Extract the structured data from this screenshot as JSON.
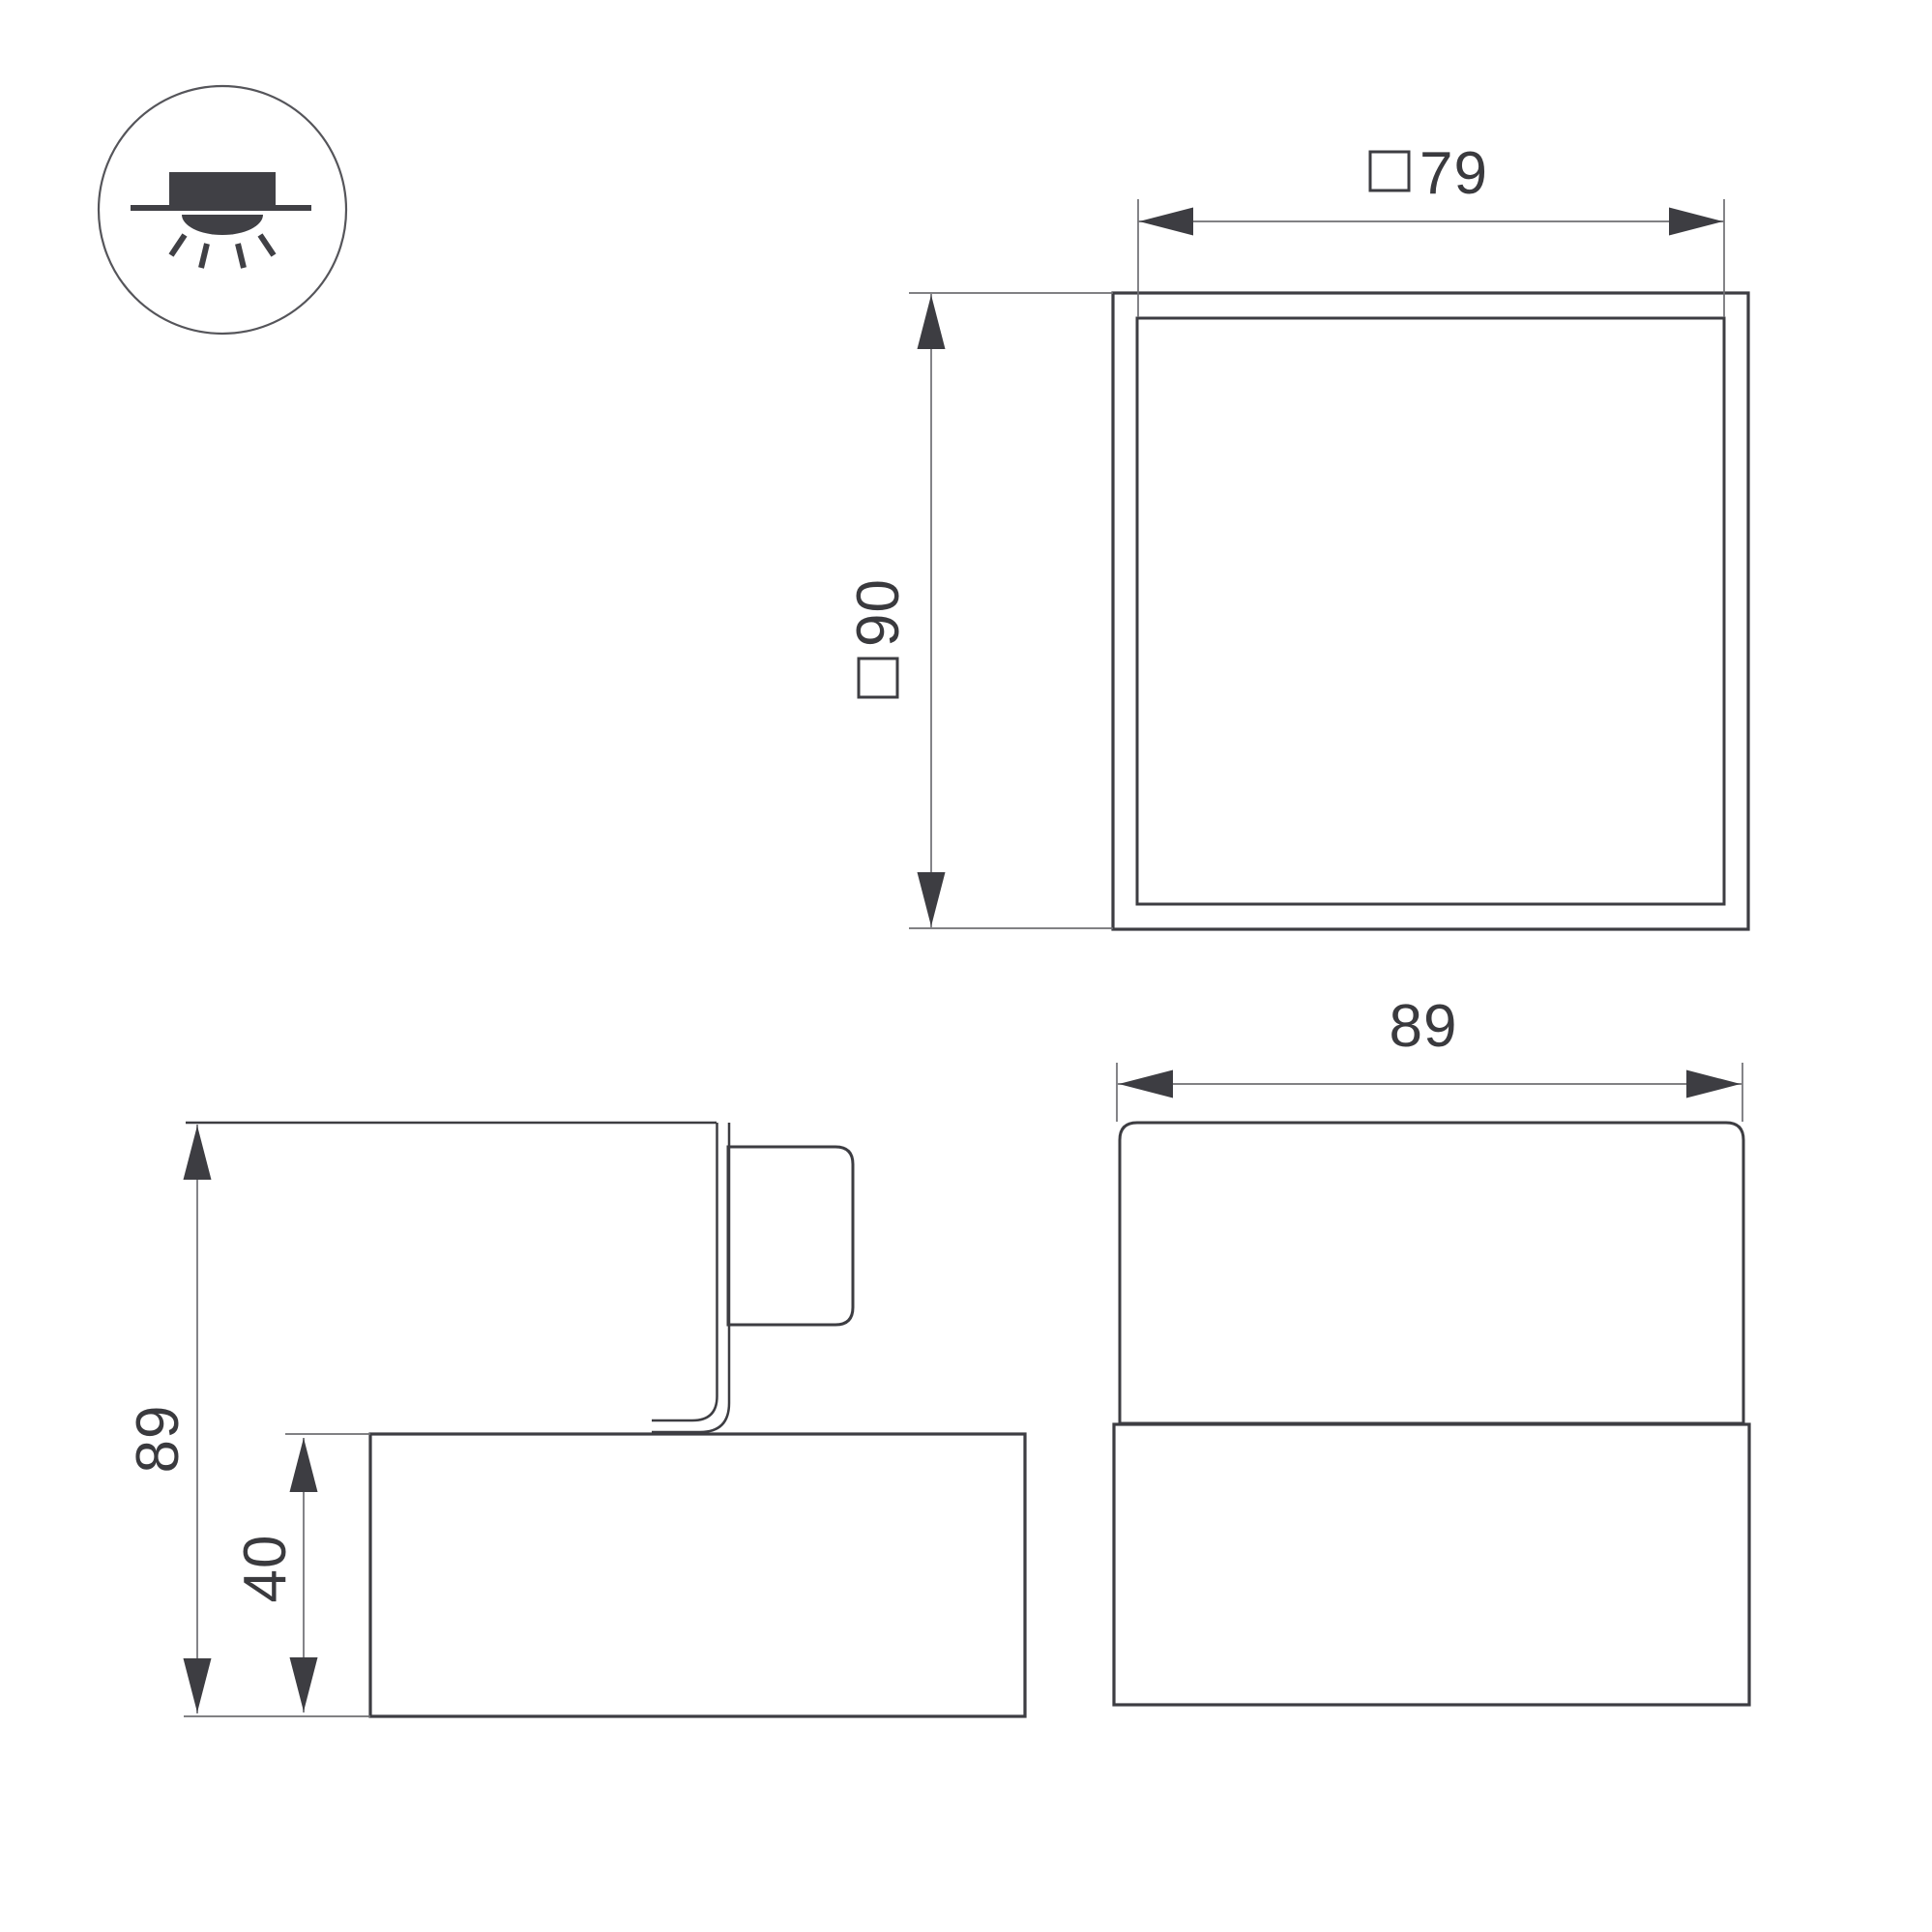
{
  "drawing": {
    "title": "luminaire dimensional drawing",
    "views": {
      "top_view": "top view with outer and inner square contours",
      "side_view": "side profile with mounting bracket and base",
      "front_view": "front elevation with shade and base"
    }
  },
  "icon": {
    "name": "surface-downlight-icon",
    "description": "ceiling surface-mounted light emitting downward"
  },
  "dimensions": {
    "top_width": {
      "symbol": "□",
      "value": "79"
    },
    "top_height": {
      "symbol": "□",
      "value": "90"
    },
    "front_width": {
      "value": "89"
    },
    "side_height": {
      "value": "89"
    },
    "base_height": {
      "value": "40"
    }
  },
  "colors": {
    "outline": "#3d3d42",
    "dimension_line": "#6f6f73",
    "text": "#3a3a3e",
    "background": "#ffffff"
  }
}
